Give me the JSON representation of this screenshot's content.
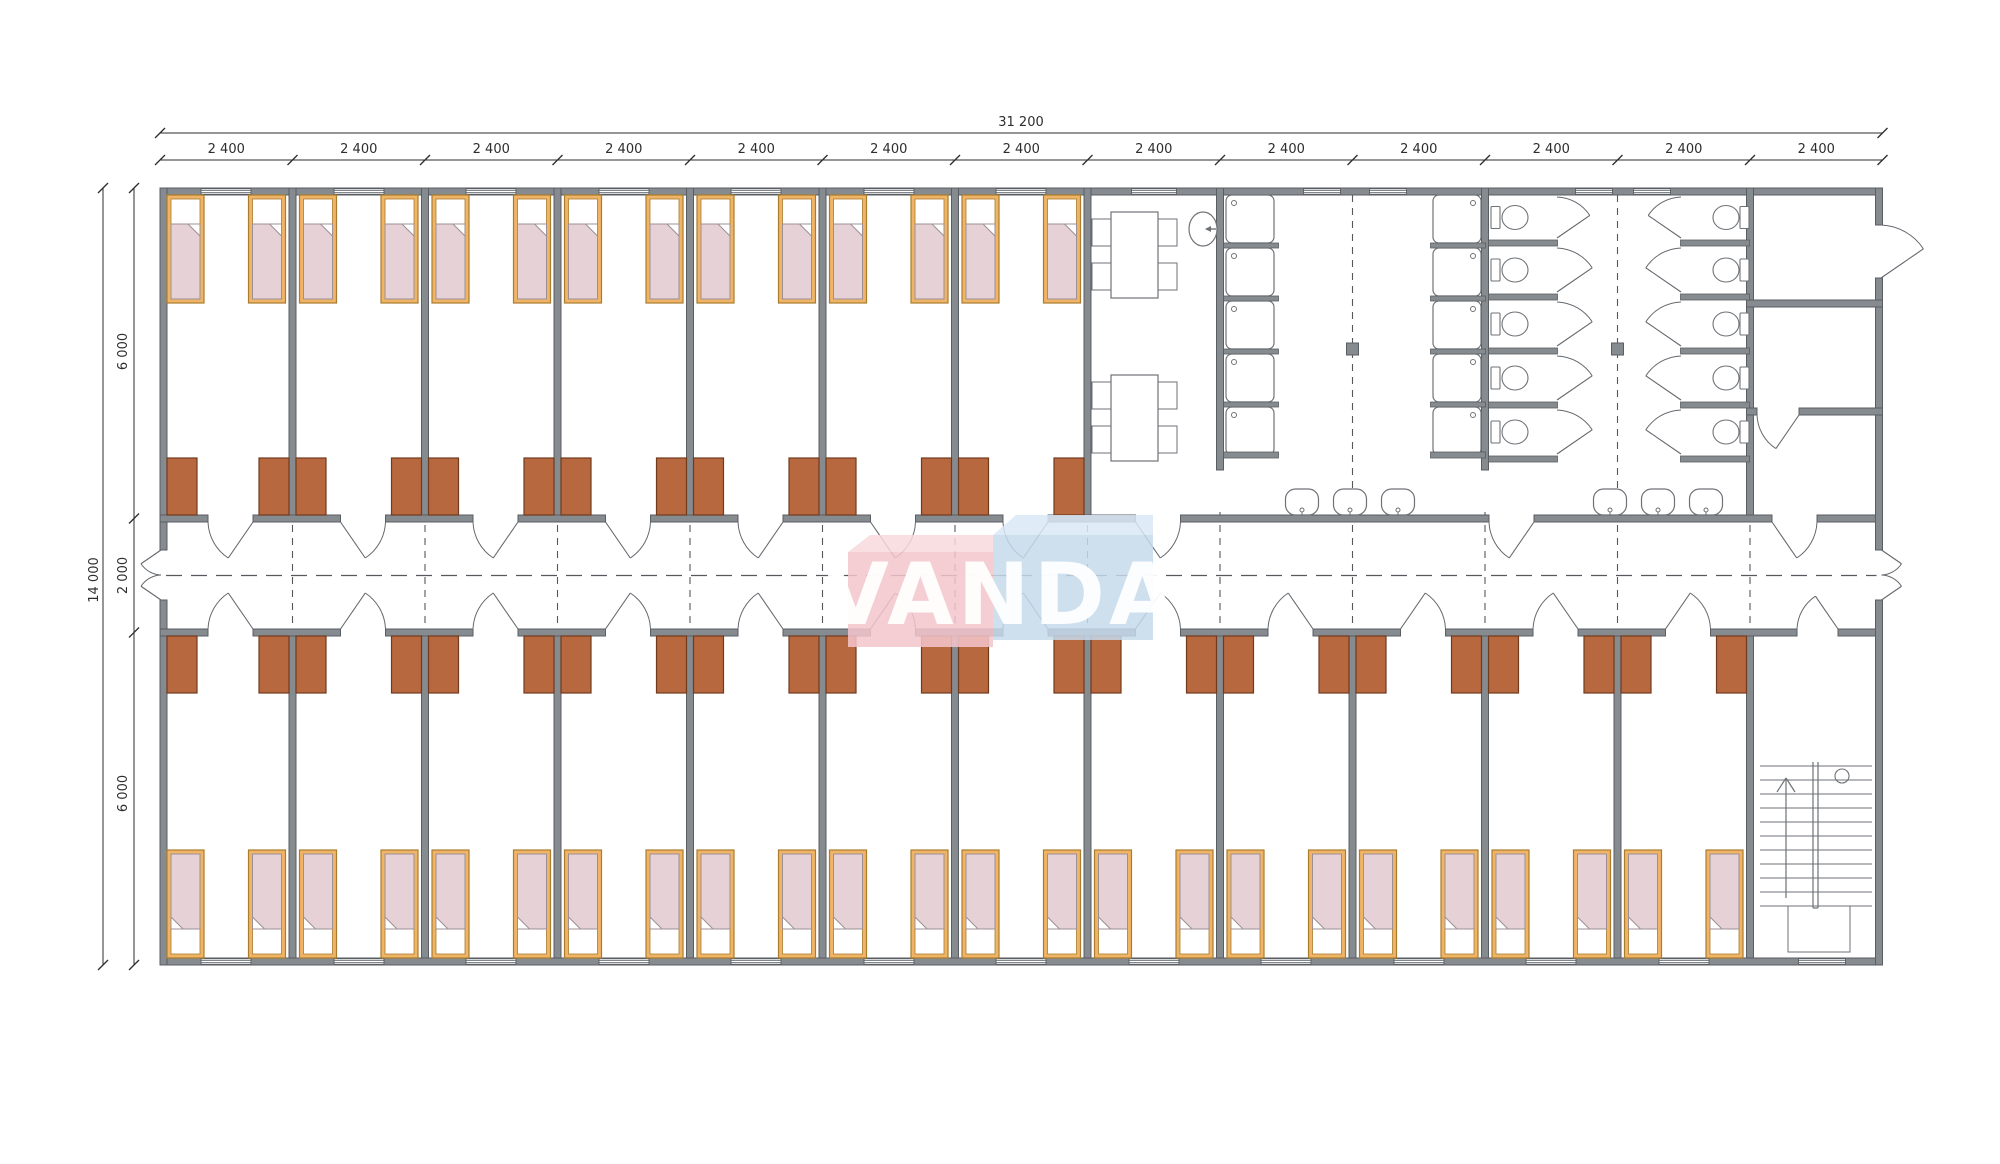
{
  "title": "Modular dormitory floor plan",
  "logo": {
    "text": "VANDA",
    "pink": "#f3c5cc",
    "pink_flap": "#f8d9dd",
    "blue": "#c6d9eb",
    "blue_flap": "#d9e8f6",
    "text_color": "#ffffff"
  },
  "dimensions": {
    "total_width_label": "31 200",
    "module_width_labels": [
      "2 400",
      "2 400",
      "2 400",
      "2 400",
      "2 400",
      "2 400",
      "2 400",
      "2 400",
      "2 400",
      "2 400",
      "2 400",
      "2 400",
      "2 400"
    ],
    "total_height_label": "14 000",
    "left_segment_labels": [
      "6 000",
      "2 000",
      "6 000"
    ]
  },
  "grid": {
    "x0": 160,
    "module_w": 132.5,
    "modules": 13,
    "top": 188,
    "corridor_top": 515,
    "corridor_bottom": 629,
    "bottom": 958,
    "wall_t": 7
  },
  "colors": {
    "wall_fill": "#868b90",
    "wall_stroke": "#595e63",
    "line": "#64686d",
    "dim": "#2e2e2e",
    "bed_frame": "#f0b466",
    "bed_frame_stroke": "#a97c2e",
    "pillow": "#ffffff",
    "blanket": "#e6d1d7",
    "blanket_stroke": "#9c9095",
    "wardrobe": "#b8683f",
    "wardrobe_stroke": "#713a1d",
    "fixture_stroke": "#6e7277",
    "dash": "#55585c"
  },
  "plan": {
    "top_bedroom_modules": [
      0,
      1,
      2,
      3,
      4,
      5,
      6
    ],
    "bottom_bedroom_modules": [
      0,
      1,
      2,
      3,
      4,
      5,
      6,
      7,
      8,
      9,
      10,
      11
    ],
    "bed": {
      "w": 37,
      "h": 108
    },
    "wardrobe": {
      "w": 30,
      "h": 57
    },
    "windows_top": [
      [
        226,
        50
      ],
      [
        359,
        50
      ],
      [
        491,
        50
      ],
      [
        624,
        50
      ],
      [
        756,
        50
      ],
      [
        889,
        50
      ],
      [
        1021,
        50
      ],
      [
        1154,
        45
      ],
      [
        1322,
        37
      ],
      [
        1388,
        37
      ],
      [
        1594,
        37
      ],
      [
        1652,
        37
      ]
    ],
    "windows_bottom": [
      [
        226,
        50
      ],
      [
        359,
        50
      ],
      [
        491,
        50
      ],
      [
        624,
        50
      ],
      [
        756,
        50
      ],
      [
        889,
        50
      ],
      [
        1021,
        50
      ],
      [
        1154,
        50
      ],
      [
        1286,
        50
      ],
      [
        1419,
        50
      ],
      [
        1551,
        50
      ],
      [
        1684,
        50
      ],
      [
        1822,
        47
      ]
    ],
    "doors": {
      "offset": 48,
      "width": 45,
      "top_modules": [
        0,
        1,
        2,
        3,
        4,
        5,
        6,
        7
      ],
      "bottom_modules": [
        0,
        1,
        2,
        3,
        4,
        5,
        6,
        7,
        8,
        9,
        10,
        11
      ],
      "extra_h": [
        [
          1489,
          1534,
          522,
          "right",
          1
        ],
        [
          1772,
          1817,
          522,
          "left",
          1
        ],
        [
          1797,
          1838,
          629,
          "right",
          -1
        ],
        [
          1757,
          1799,
          415,
          "right",
          1
        ]
      ],
      "exterior_right": [
        1881,
        278,
        225
      ],
      "double_doors_y": [
        550,
        600
      ]
    },
    "bathroom": {
      "grid_dash_x": [
        1352.5,
        1617.5
      ],
      "column_marker_y": 343,
      "showers": [
        {
          "x": 1226,
          "drain": "left"
        },
        {
          "x": 1433,
          "drain": "right"
        }
      ],
      "shower": {
        "w": 48,
        "h": 48,
        "ys": [
          195,
          248,
          301,
          354,
          407
        ]
      },
      "toilet_cols": [
        {
          "front": 1557,
          "tank_x": 1491,
          "bowl_cx": 1515,
          "hinge": "right"
        },
        {
          "front": 1681,
          "tank_x": 1740,
          "bowl_cx": 1726,
          "hinge": "left"
        }
      ],
      "stall_tops": [
        195,
        246,
        300,
        354,
        408
      ],
      "stall_bottoms": [
        240,
        294,
        348,
        402,
        456
      ],
      "basins": [
        1302,
        1350,
        1398,
        1610,
        1658,
        1706
      ],
      "basin": {
        "w": 33,
        "h": 26,
        "y": 489
      }
    },
    "dining": {
      "tables": [
        [
          1111,
          212
        ],
        [
          1111,
          375
        ]
      ],
      "table": {
        "w": 47,
        "h": 86
      },
      "chair": {
        "w": 20,
        "h": 27
      },
      "sink": {
        "cx": 1203,
        "cy": 229,
        "rx": 14,
        "ry": 17
      }
    },
    "stairs": {
      "x1": 1760,
      "x2": 1872,
      "y1": 766,
      "y2": 906,
      "treads": 10,
      "divider_x": 1813,
      "arrow_x": 1786,
      "circle": [
        1842,
        776
      ],
      "landing": [
        1788,
        906,
        1850,
        952
      ]
    }
  }
}
